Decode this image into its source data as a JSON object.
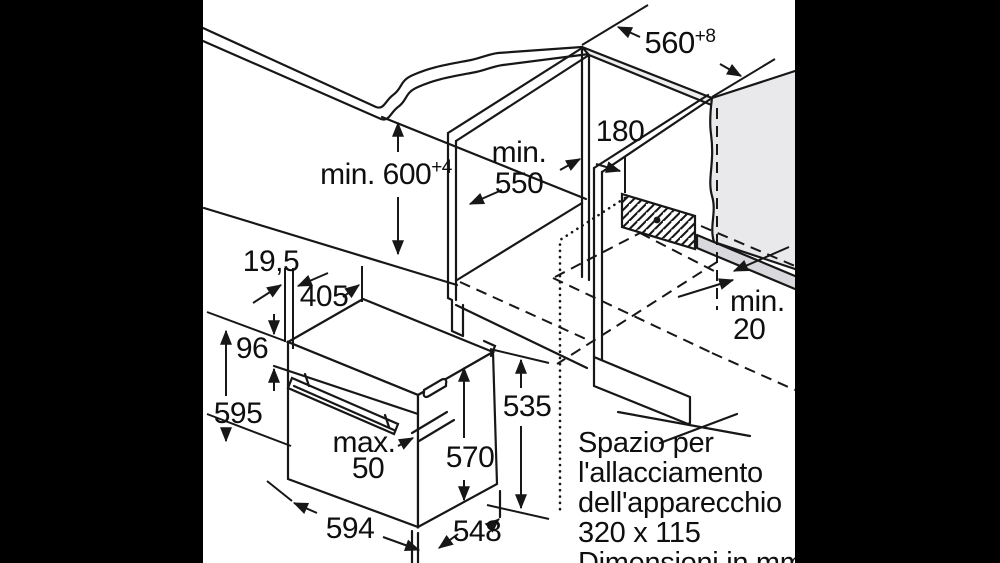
{
  "colors": {
    "frame": "#000000",
    "paper": "#ffffff",
    "line": "#171717",
    "surface_gray": "#e9e9ec",
    "edge_band_gray": "#eeeef1",
    "strip_gray": "#d9d9dd"
  },
  "diagram": {
    "dims": {
      "top_width": "560",
      "top_width_tol": "+8",
      "niche_height": "min. 600",
      "niche_height_tol": "+4",
      "niche_depth_1": "min.",
      "niche_depth_2": "550",
      "side_offset": "180",
      "rear_gap_1": "min.",
      "rear_gap_2": "20",
      "front_trim": "19,5",
      "top_depth": "405",
      "control_panel_height": "96",
      "total_height": "595",
      "door_protrusion_1": "max.",
      "door_protrusion_2": "50",
      "front_height": "570",
      "rear_height": "535",
      "width": "594",
      "depth": "548"
    },
    "note": {
      "line1": "Spazio per",
      "line2": "l'allacciamento",
      "line3": "dell'apparecchio",
      "line4": "320 x 115",
      "line5": "Dimensioni in mm"
    }
  }
}
